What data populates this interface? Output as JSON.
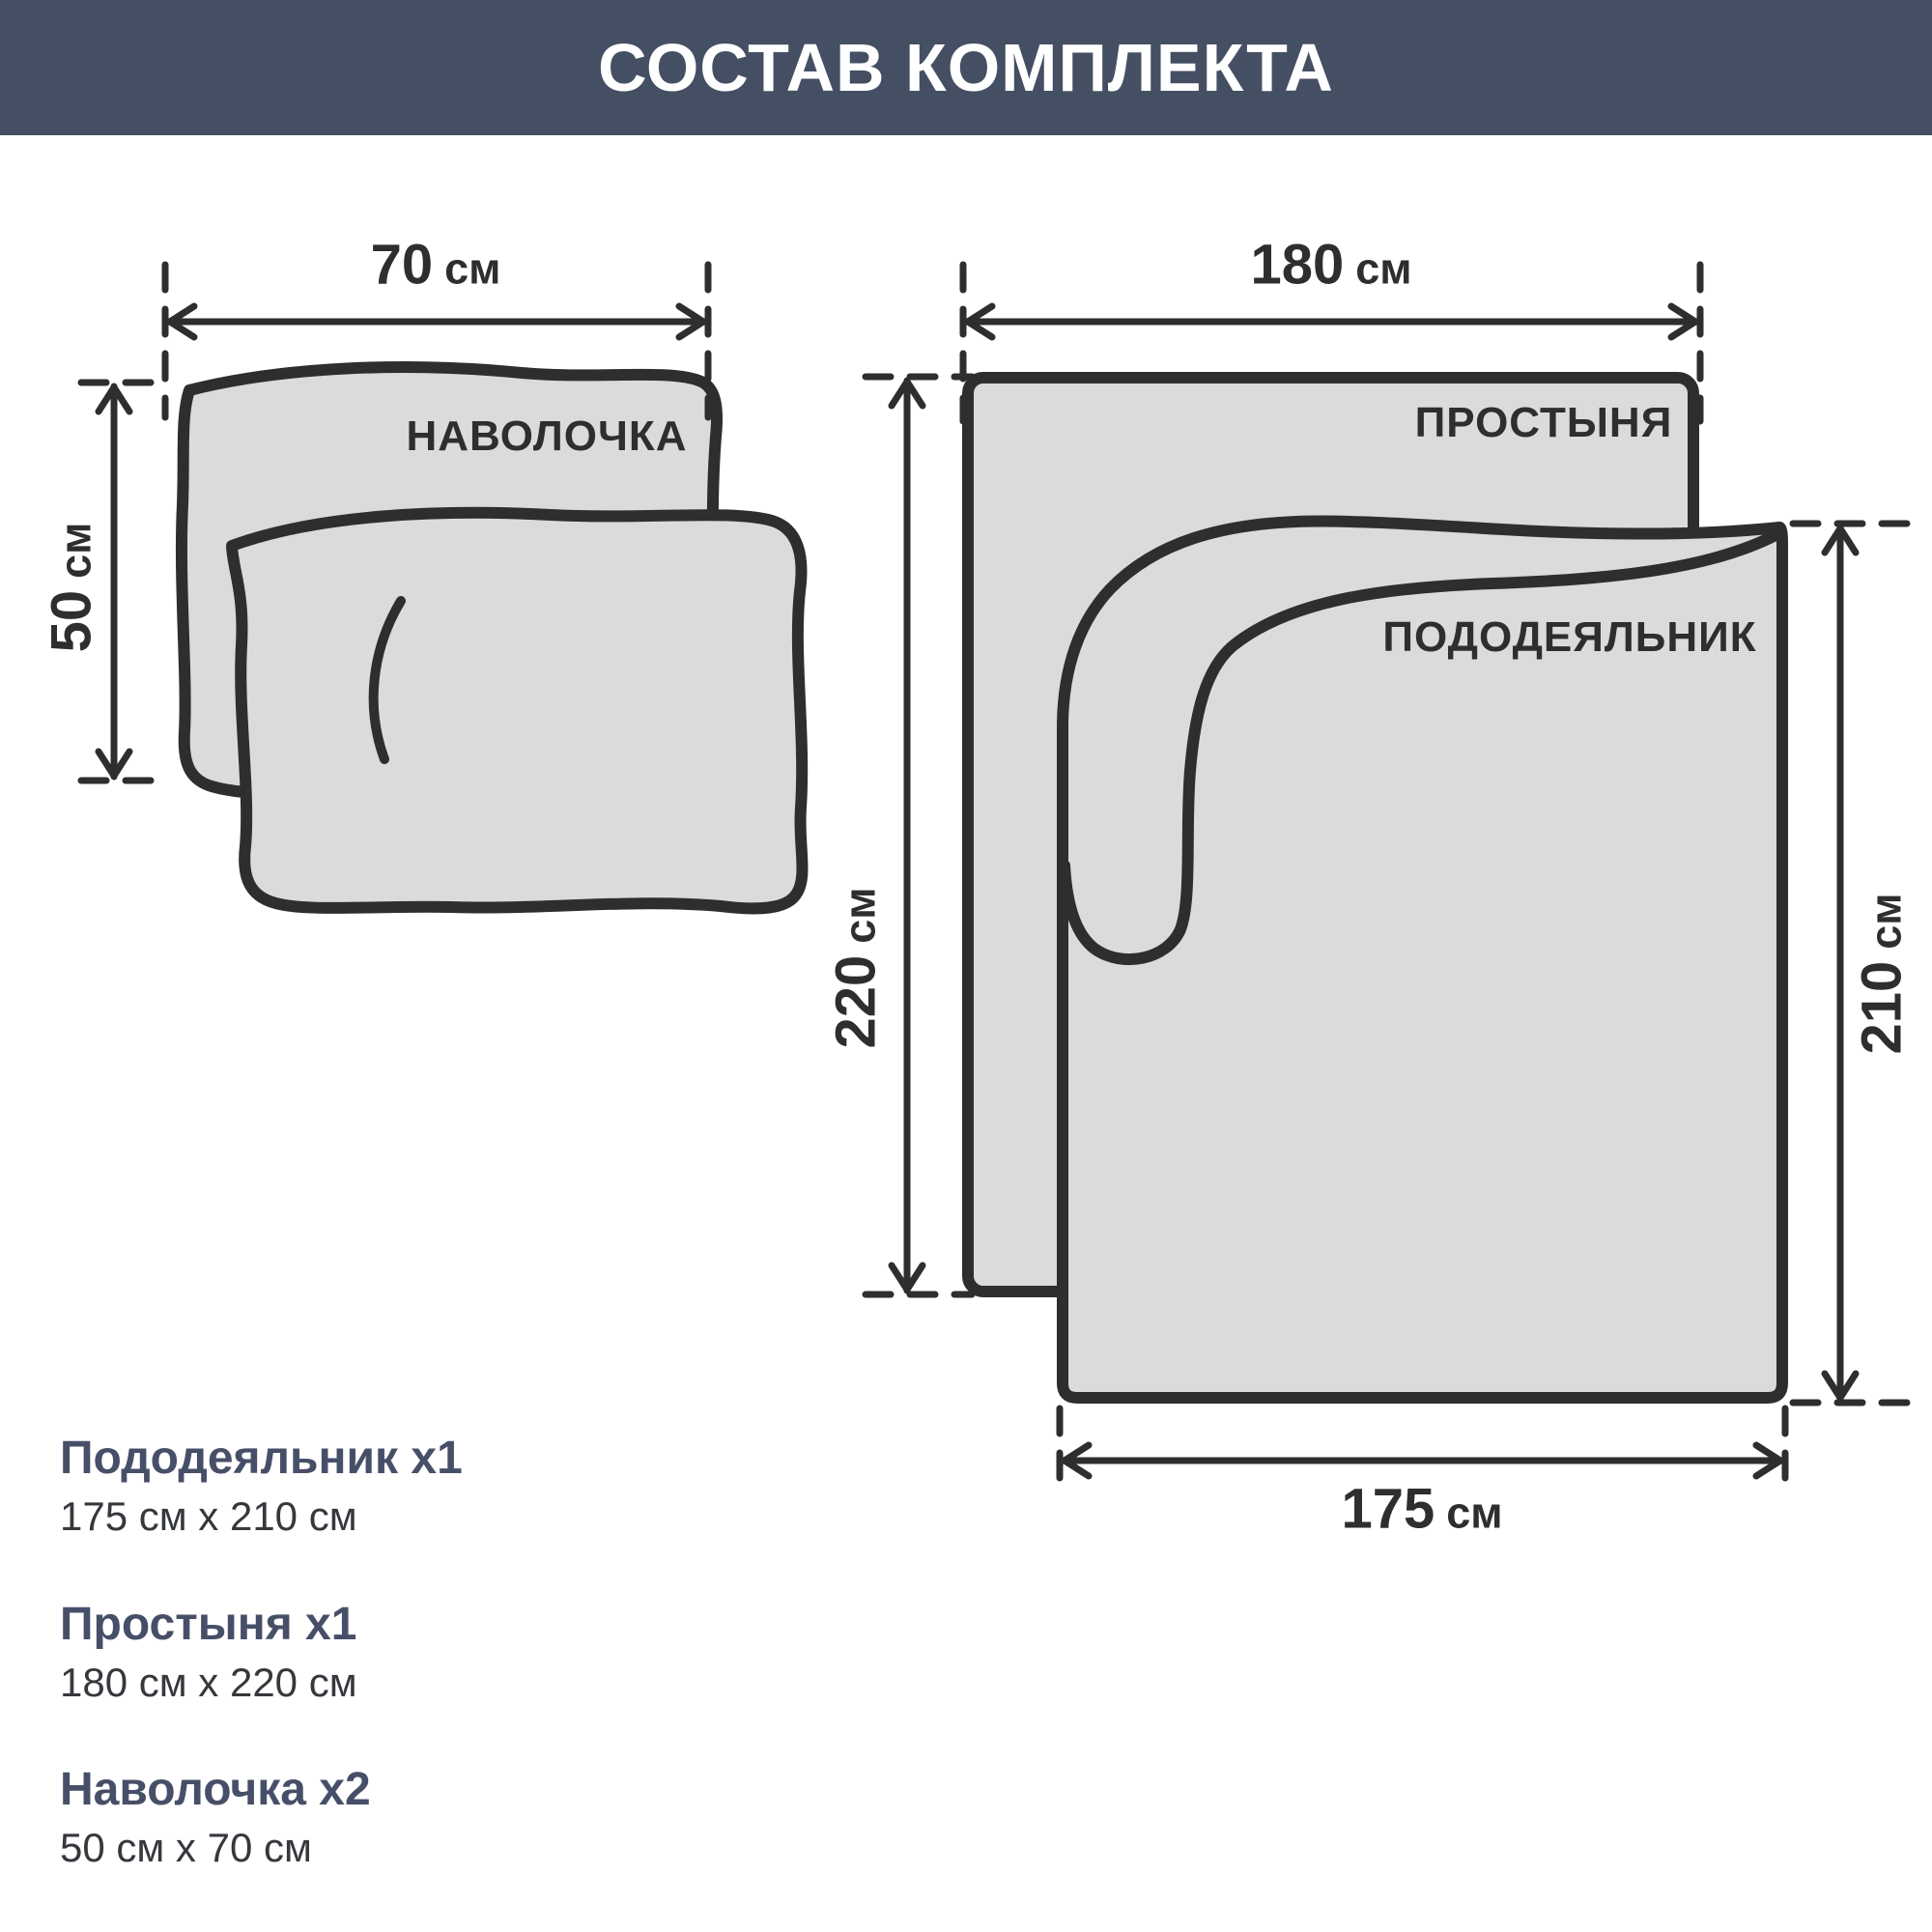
{
  "header": {
    "title": "СОСТАВ КОМПЛЕКТА"
  },
  "diagram": {
    "pillowcase": {
      "label": "НАВОЛОЧКА",
      "width": {
        "value": "70",
        "unit": "см"
      },
      "height": {
        "value": "50",
        "unit": "см"
      }
    },
    "sheet": {
      "label": "ПРОСТЫНЯ",
      "width": {
        "value": "180",
        "unit": "см"
      },
      "height": {
        "value": "220",
        "unit": "см"
      }
    },
    "duvet": {
      "label": "ПОДОДЕЯЛЬНИК",
      "width": {
        "value": "175",
        "unit": "см"
      },
      "height": {
        "value": "210",
        "unit": "см"
      }
    }
  },
  "items": [
    {
      "title": "Пододеяльник х1",
      "size": "175 см х 210 см"
    },
    {
      "title": "Простыня х1",
      "size": "180 см х 220 см"
    },
    {
      "title": "Наволочка х2",
      "size": "50 см х 70 см"
    }
  ],
  "colors": {
    "header_bg": "#454F63",
    "header_text": "#FFFFFF",
    "shape_fill": "#DBDBDB",
    "outline": "#2E2E2E",
    "list_title": "#474F68",
    "list_size": "#35383D"
  }
}
